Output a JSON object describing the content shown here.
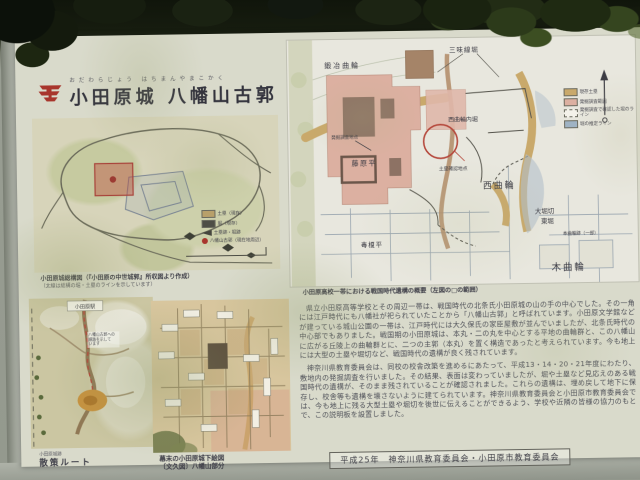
{
  "colors": {
    "red_accent": "#a8352c",
    "tan_earthwork": "#c9a96b",
    "pink_survey": "#dcb0a1",
    "blue_hatch": "#9fb3c4",
    "sign_base": "#d9dacb"
  },
  "sign": {
    "furigana": "おだわらじょう はちまんやまこかく",
    "title": "小田原城 八幡山古郭",
    "emblem": "odawara-city-emblem",
    "credit": "平成25年　神奈川県教育委員会・小田原市教育委員会"
  },
  "overview_map": {
    "caption": "小田原城総構図（『小田原の中世城郭』所収図より作成）",
    "caption2": "（太線は総構の堀・土塁のラインを示しています）",
    "legend": [
      {
        "label": "土塁（現存）"
      },
      {
        "label": "堀（現存）"
      },
      {
        "label": "土塁跡・堀跡"
      },
      {
        "label": "八幡山古郭（現在地周辺）"
      }
    ]
  },
  "route_map": {
    "station_label": "小田原駅",
    "note": "八幡山古郭への\n順路を示して\nいます",
    "caption_small": "小田原城跡",
    "caption": "散策ルート"
  },
  "edo_map": {
    "caption_line1": "幕末の小田原城下絵図",
    "caption_line2": "〔文久図〕八幡山部分"
  },
  "site_map": {
    "caption": "小田原高校一帯における戦国時代遺構の概要（左図の□の範囲）",
    "labels": {
      "kaji": "鍛冶曲輪",
      "shamisen": "三味線堀",
      "nishi_uchibori": "西曲輪内堀",
      "nishi": "西曲輪",
      "fujiwara": "藤原平",
      "chosa": "発掘調査地点",
      "dorui": "土塁確認地点",
      "obori1": "大堀切",
      "obori2": "東堀",
      "honkuruwa_ato": "本曲輪跡（一部）",
      "kikuruwa": "木曲輪",
      "dokue": "毒榎平"
    },
    "legend": [
      {
        "label": "現存土塁"
      },
      {
        "label": "発掘調査範囲"
      },
      {
        "label": "発掘調査で確認した堀のライン"
      },
      {
        "label": "堀の推定ライン"
      }
    ]
  },
  "body": {
    "para1": "県立小田原高等学校とその周辺一帯は、戦国時代の北条氏小田原城の山の手の中心でした。その一角には江戸時代にも八幡社が祀られていたことから「八幡山古郭」と呼ばれています。小田原文学館などが建っている城山公園の一帯は、江戸時代には大久保氏の家臣屋敷が並んでいましたが、北条氏時代の中心部でもありました。戦国期の小田原城は、本丸・二の丸を中心とする平地の曲輪群と、この八幡山に広がる丘陵上の曲輪群とに、二つの主郭（本丸）を置く構造であったと考えられています。今も地上には大型の土塁や堀切など、戦国時代の遺構が良く残されています。",
    "para2": "神奈川県教育委員会は、同校の校舎改築を進めるにあたって、平成13・14・20・21年度にわたり、敷地内の発掘調査を行いました。その結果、表面は変わっていましたが、堀や土塁など見応えのある戦国時代の遺構が、そのまま残されていることが確認されました。これらの遺構は、埋め戻して地下に保存し、校舎等も遺構を壊さないように建てられています。神奈川県教育委員会と小田原市教育委員会では、今も地上に残る大型土塁や堀切を後世に伝えることができるよう、学校や近隣の皆様の協力のもとで、この説明板を設置しました。"
  }
}
